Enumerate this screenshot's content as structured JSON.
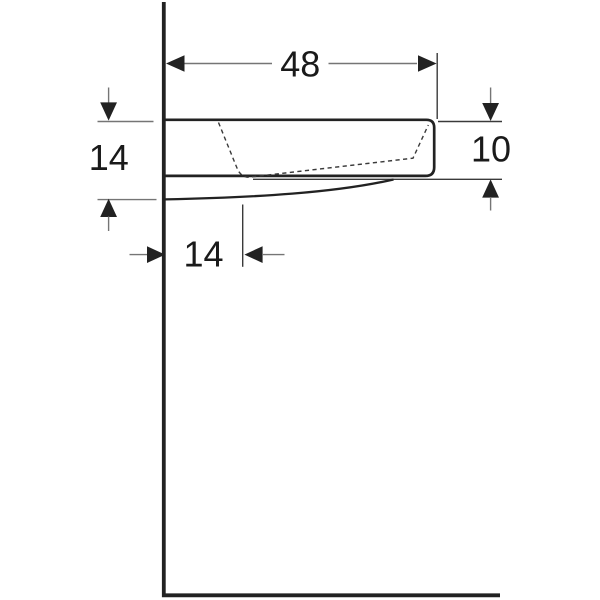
{
  "drawing": {
    "kind": "technical dimension drawing, side profile of wall-hung washbasin",
    "dimension_labels": {
      "top_width": "48",
      "left_height": "14",
      "right_height": "10",
      "bottom_depth": "14"
    }
  },
  "colors": {
    "background": "#ffffff",
    "line_dark": "#222222",
    "line_thin": "#3a3a3a",
    "line_gray": "#757575",
    "text": "#1a1a1a"
  }
}
